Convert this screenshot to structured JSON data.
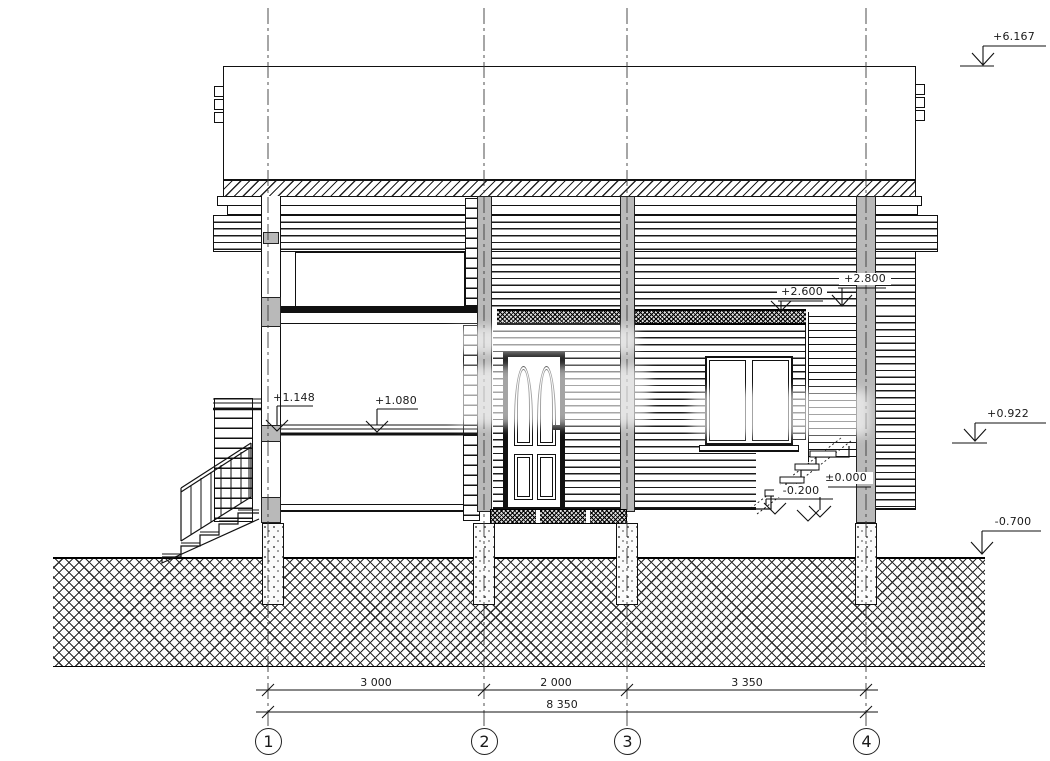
{
  "levels": {
    "roof": "+6.167",
    "right_mid": "+0.922",
    "ground": "-0.700",
    "canopy_upper": "+2.800",
    "canopy_lower": "+2.600",
    "terrace": "+1.148",
    "floor": "+1.080",
    "zero": "±0.000",
    "entry_step": "-0.200"
  },
  "dimensions": {
    "span_1_2": "3 000",
    "span_2_3": "2 000",
    "span_3_4": "3 350",
    "total": "8 350"
  },
  "axes": [
    "1",
    "2",
    "3",
    "4"
  ],
  "colors": {
    "line": "#1a1a1a",
    "section_fill": "#b9b9b9",
    "paper": "#ffffff"
  }
}
